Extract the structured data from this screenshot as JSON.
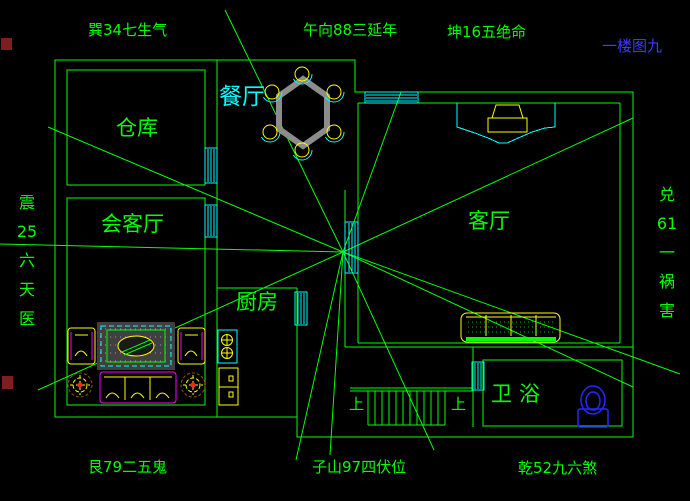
{
  "page": {
    "title_note": "一楼图九"
  },
  "compass": {
    "top_left": "巽34七生气",
    "top_center": "午向88三延年",
    "top_right": "坤16五绝命",
    "bottom_left": "艮79二五鬼",
    "bottom_center": "子山97四伏位",
    "bottom_right": "乾52九六煞",
    "left_column": [
      "震",
      "25",
      "六",
      "天",
      "医"
    ],
    "right_column": [
      "兑",
      "61",
      "一",
      "祸",
      "害"
    ]
  },
  "rooms": {
    "storage": "仓库",
    "dining": "餐厅",
    "reception": "会客厅",
    "kitchen": "厨房",
    "living": "客厅",
    "bathroom": "卫浴"
  },
  "stairs": {
    "up_left": "上",
    "up_right": "上"
  },
  "colors": {
    "background": "#000000",
    "wall_green": "#00FF00",
    "window_cyan": "#00FFFF",
    "furniture_yellow": "#FFFF00",
    "furniture_magenta": "#FF00FF",
    "table_gray": "#8C8C8C",
    "toilet_blue": "#2626FF",
    "title_blue": "#3C3CFF",
    "grip_red": "#7D1F1F"
  }
}
